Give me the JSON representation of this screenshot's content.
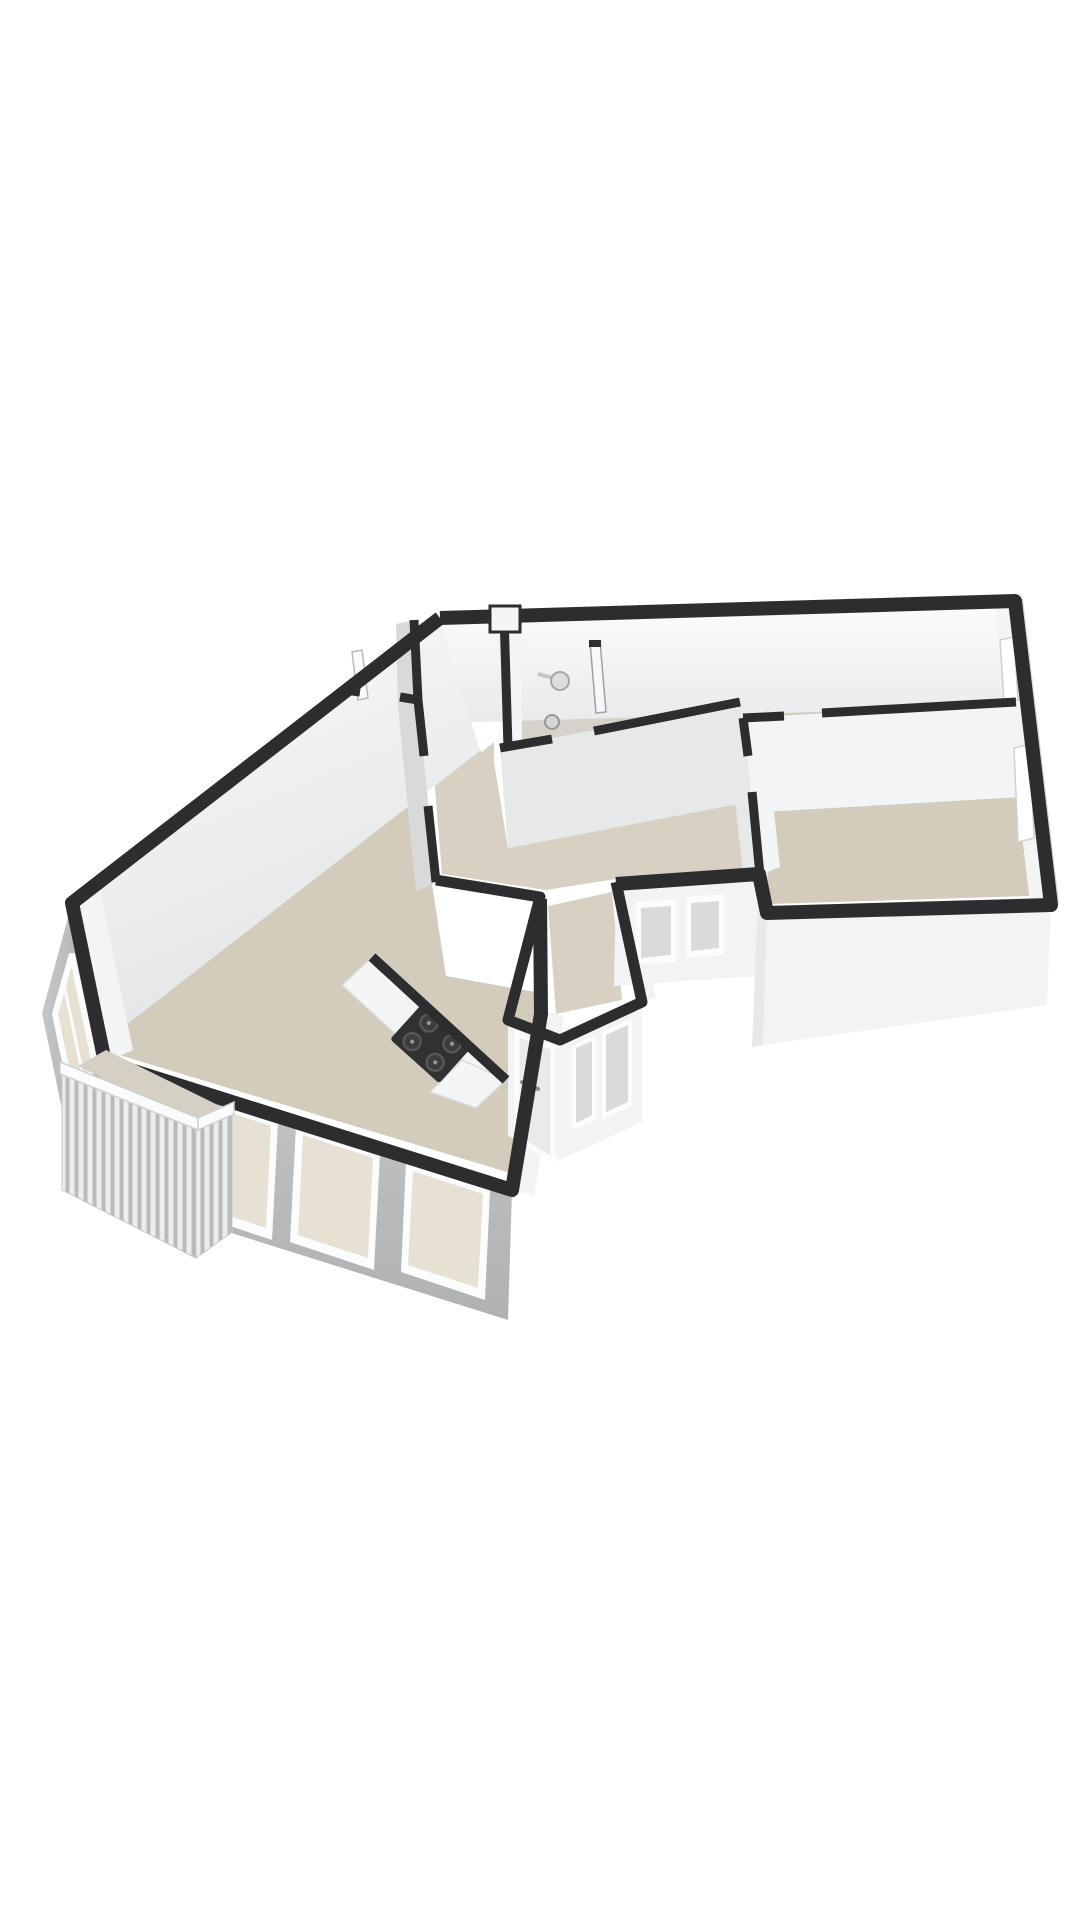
{
  "scene": {
    "kind": "3d-floorplan-render",
    "description": "Isometric 3D floor plan of an apartment, white background, dark wall tops, beige floors",
    "background": "#ffffff"
  },
  "colors": {
    "wallTop": "#2d2d2f",
    "extFaceGreyLight": "#c9cacc",
    "extFaceGrey": "#b4b5b7",
    "extFaceWhite": "#f2f3f5",
    "intFaceLight": "#f3f4f6",
    "intFaceMid": "#e7e8ea",
    "intFaceShade": "#d8d9db",
    "floorMain": "#d3cbbc",
    "floorHall": "#d8d1c3",
    "floorBath": "#d6d2c9",
    "floorBalcony": "#d6d0c4",
    "glassWarm": "#e7e1d4",
    "glassCool": "#d9dadc",
    "counterWhite": "#f4f5f6",
    "cooktopBlack": "#313133",
    "burnerGrey": "#56565a",
    "frameWhite": "#fbfcfd",
    "railingSlat": "#b9babc",
    "railingBase": "#eceded",
    "doorPanel": "#e9eaec"
  },
  "rooms": [
    {
      "id": "living-room",
      "label": "living room with open kitchen"
    },
    {
      "id": "hallway",
      "label": "central hallway"
    },
    {
      "id": "bathroom",
      "label": "bathroom with shower"
    },
    {
      "id": "bedroom-top-right",
      "label": "bedroom north-east"
    },
    {
      "id": "bedroom-mid-right",
      "label": "bedroom east"
    },
    {
      "id": "entrance-bay",
      "label": "entrance bay with front door"
    },
    {
      "id": "balcony",
      "label": "balcony with slatted railing"
    }
  ],
  "fixtures": {
    "cooktop_burners": 4,
    "shower_fixtures": 2,
    "front_doors": 1,
    "balcony_door_panels": 2,
    "windows_southwest": 3,
    "windows_west": 1,
    "windows_bay": 2,
    "windows_hall_south": 2,
    "railing_slats": 17
  }
}
